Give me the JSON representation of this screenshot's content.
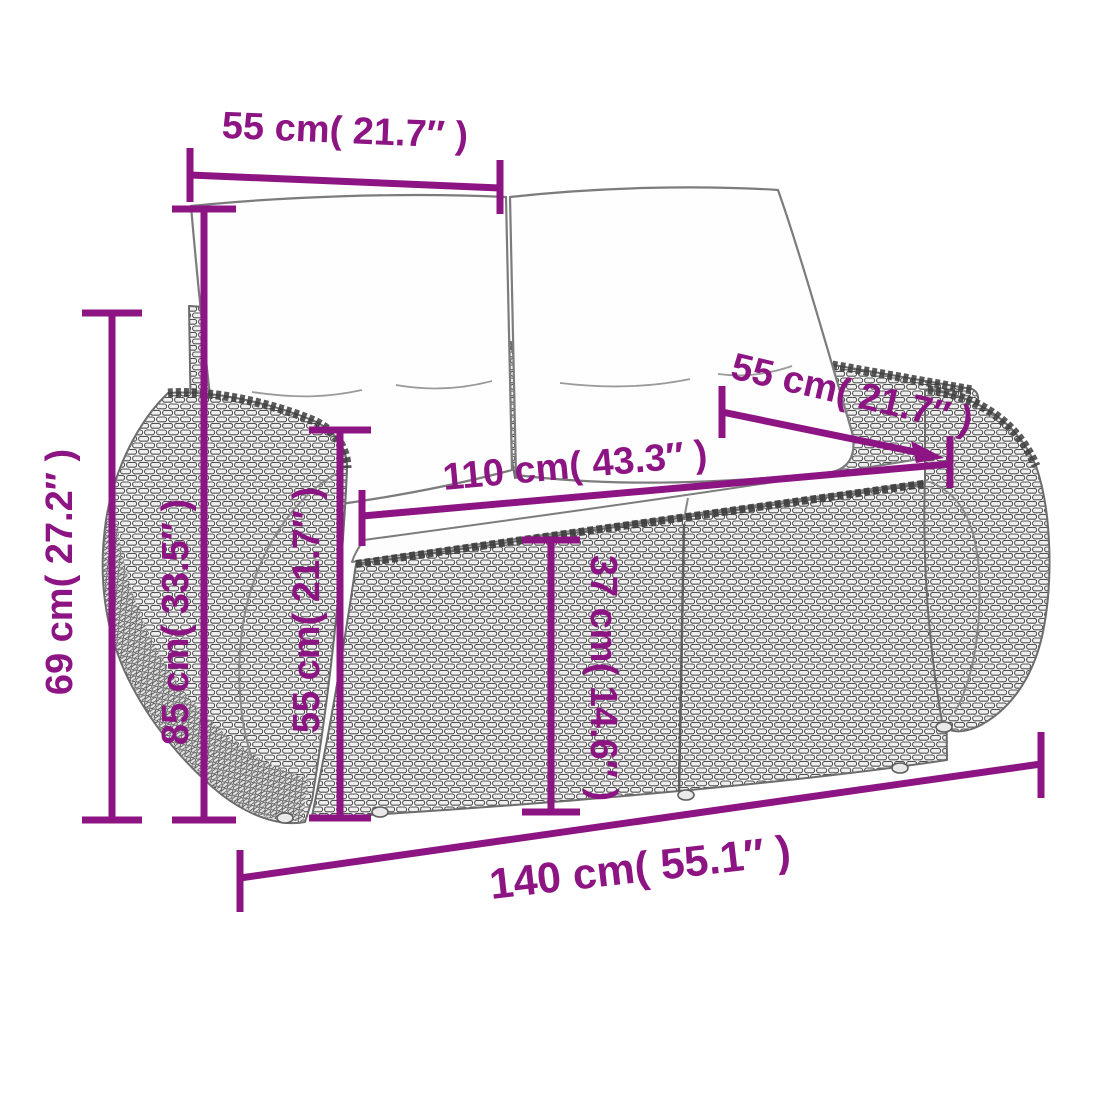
{
  "diagram": {
    "labels": {
      "back_cushion_width_top": "55 cm( 21.7″ )",
      "backrest_width_right": "55 cm( 21.7″ )",
      "seat_width": "110 cm( 43.3″ )",
      "overall_height": "69 cm( 27.2″ )",
      "back_height": "85 cm( 33.5″ )",
      "armrest_height": "55 cm( 21.7″ )",
      "seat_height": "37 cm( 14.6″ )",
      "overall_width": "140 cm( 55.1″ )"
    },
    "colors": {
      "dimension_accent": "#8D1483",
      "line_art_gray": "#6D6D6D",
      "weave_stroke": "#4F4F4F",
      "cushion_fill": "#FEFEFE"
    }
  }
}
